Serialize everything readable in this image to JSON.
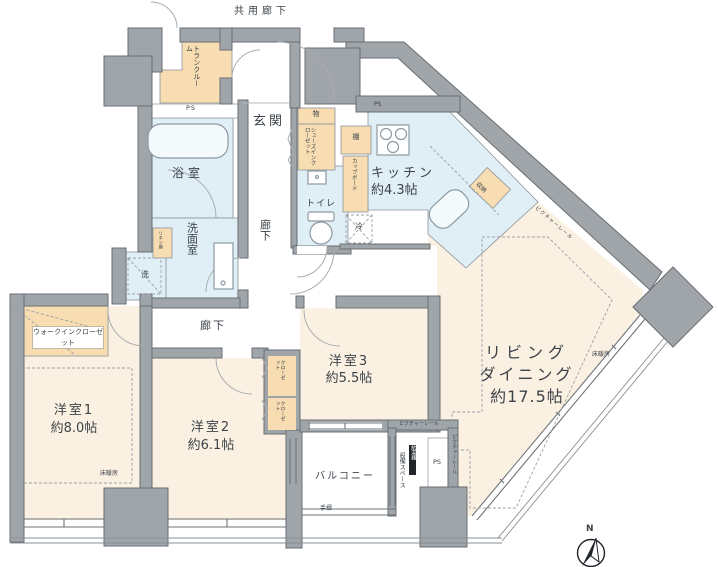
{
  "colors": {
    "wall_fill": "#a0a5aa",
    "wall_border": "#696e73",
    "room_cream": "#fbf1e2",
    "closet_beige": "#f7ddb1",
    "wet_area_blue": "#e0eef6",
    "fixture_white": "#f4fafc",
    "text": "#3c4249"
  },
  "header": {
    "common_corridor": "共用廊下"
  },
  "rooms": {
    "living_dining": {
      "line1": "リビング",
      "line2": "ダイニング",
      "size": "約17.5帖"
    },
    "kitchen": {
      "name": "キッチン",
      "size": "約4.3帖"
    },
    "bedroom1": {
      "name": "洋室1",
      "size": "約8.0帖"
    },
    "bedroom2": {
      "name": "洋室2",
      "size": "約6.1帖"
    },
    "bedroom3": {
      "name": "洋室3",
      "size": "約5.5帖"
    },
    "bathroom": "浴室",
    "washroom": "洗面室",
    "toilet": "トイレ",
    "entrance": "玄関",
    "balcony": "バルコニー",
    "corridor": "廊下",
    "trunk_room": "トランクルーム"
  },
  "storage": {
    "walk_in_closet": "ウォークインクローゼット",
    "shoes_in_closet": "シューズインクローゼット",
    "closet": "クローゼット",
    "cupboard": "カップボード",
    "storage": "収納",
    "shelf": "棚",
    "goods": "物",
    "linen": "リネン庫"
  },
  "equipment": {
    "equipment_space": "設備スペース",
    "water_heater": "給湯器",
    "ps": "PS",
    "washer": "洗",
    "fridge": "冷"
  },
  "annotations": {
    "floor_heating": "床暖房",
    "picture_rail": "ピクチャーレール",
    "handrail": "手摺",
    "north": "N"
  }
}
